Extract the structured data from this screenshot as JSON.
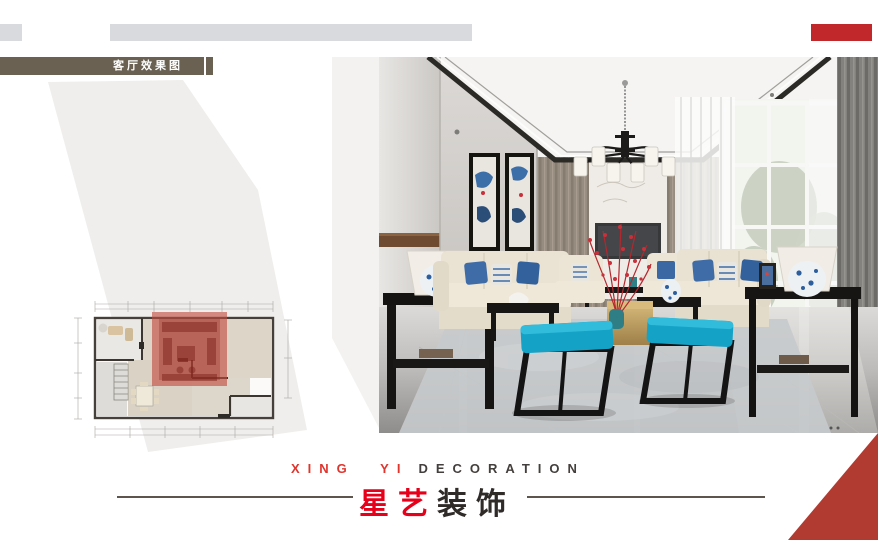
{
  "header": {
    "label": "客厅效果图",
    "label_bg": "#6a6152",
    "bar_gray": "#d9dadd",
    "bar_red": "#c0282c"
  },
  "floor_plan": {
    "highlight_color": "#c24a3e",
    "wall_color": "#45403a"
  },
  "photo": {
    "colors": {
      "ottoman_cyan": "#14a3c7",
      "sofa_cream": "#eae3d3",
      "blossom_red": "#c9303a",
      "porcelain_blue": "#2c5e9d",
      "table_gold": "#c5a364",
      "drape_gray": "#7b7976"
    }
  },
  "footer": {
    "english": {
      "red": "XING YI",
      "dark": "DECORATION"
    },
    "chinese": {
      "red": "星艺",
      "dark": "装饰"
    },
    "accent_red": "#e0342c",
    "corner_triangle": "#b13a31"
  }
}
